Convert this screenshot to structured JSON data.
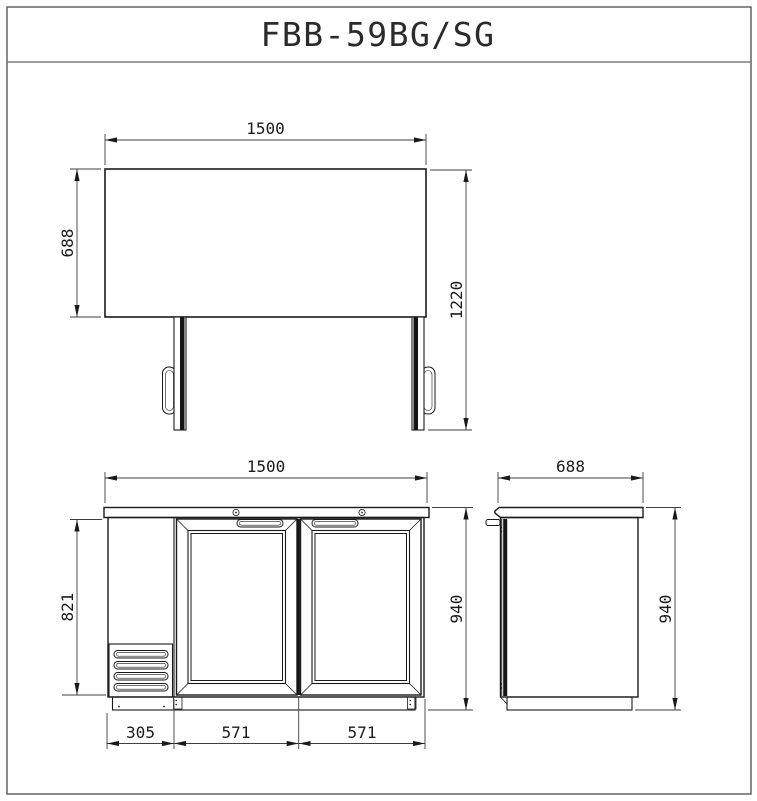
{
  "title": "FBB-59BG/SG",
  "drawing": {
    "plan": {
      "width": "1500",
      "depth": "688",
      "depth_doors_open": "1220"
    },
    "front": {
      "width": "1500",
      "body_height": "821",
      "overall_height": "940",
      "compressor_width": "305",
      "left_door_width": "571",
      "right_door_width": "571"
    },
    "side": {
      "depth": "688",
      "overall_height": "940"
    }
  },
  "colors": {
    "background": "#ffffff",
    "outline": "#1a1a1a",
    "dimension_line": "#3f3f3f",
    "sheet_frame": "#595959"
  }
}
